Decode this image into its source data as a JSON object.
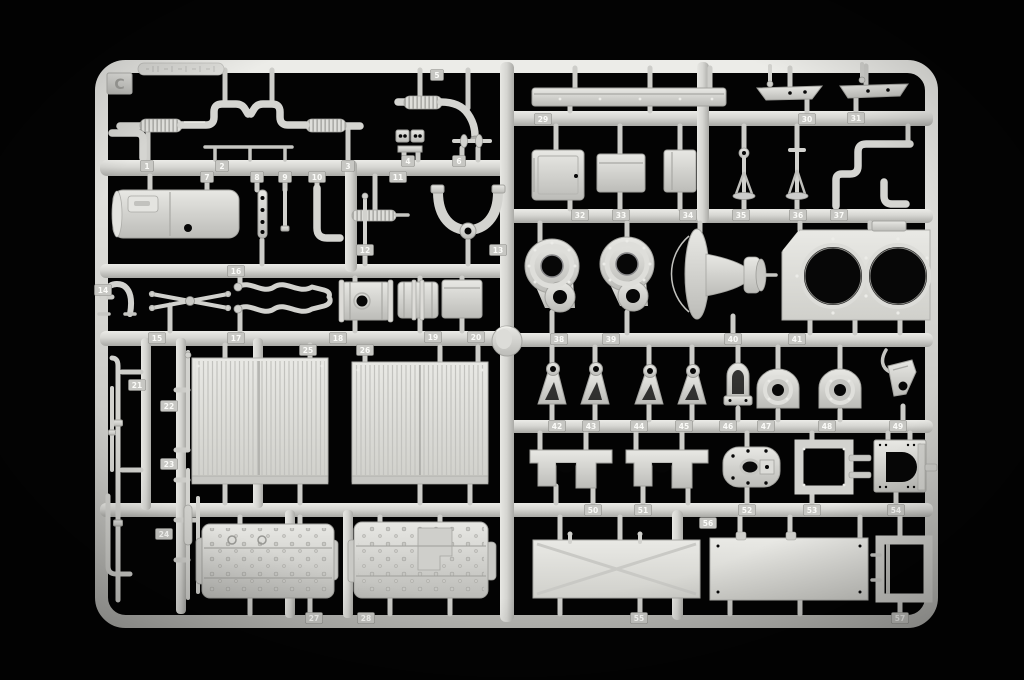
{
  "scene": {
    "background_color": "#030303",
    "plastic_color": "#d6d6d2",
    "tag_color": "#c7c7c3"
  },
  "sprue": {
    "letter": "C",
    "tags": [
      {
        "n": "1",
        "x": 147,
        "y": 166
      },
      {
        "n": "2",
        "x": 222,
        "y": 166
      },
      {
        "n": "3",
        "x": 348,
        "y": 166
      },
      {
        "n": "4",
        "x": 408,
        "y": 161
      },
      {
        "n": "5",
        "x": 437,
        "y": 75
      },
      {
        "n": "6",
        "x": 459,
        "y": 161
      },
      {
        "n": "7",
        "x": 207,
        "y": 177
      },
      {
        "n": "8",
        "x": 257,
        "y": 177
      },
      {
        "n": "9",
        "x": 285,
        "y": 177
      },
      {
        "n": "10",
        "x": 317,
        "y": 177
      },
      {
        "n": "11",
        "x": 398,
        "y": 177
      },
      {
        "n": "12",
        "x": 365,
        "y": 250
      },
      {
        "n": "13",
        "x": 498,
        "y": 250
      },
      {
        "n": "14",
        "x": 103,
        "y": 290
      },
      {
        "n": "15",
        "x": 157,
        "y": 338
      },
      {
        "n": "16",
        "x": 236,
        "y": 271
      },
      {
        "n": "17",
        "x": 236,
        "y": 338
      },
      {
        "n": "18",
        "x": 338,
        "y": 338
      },
      {
        "n": "19",
        "x": 433,
        "y": 337
      },
      {
        "n": "20",
        "x": 476,
        "y": 337
      },
      {
        "n": "21",
        "x": 137,
        "y": 385
      },
      {
        "n": "22",
        "x": 169,
        "y": 406
      },
      {
        "n": "23",
        "x": 169,
        "y": 464
      },
      {
        "n": "24",
        "x": 164,
        "y": 534
      },
      {
        "n": "25",
        "x": 308,
        "y": 350
      },
      {
        "n": "26",
        "x": 365,
        "y": 350
      },
      {
        "n": "27",
        "x": 314,
        "y": 618
      },
      {
        "n": "28",
        "x": 366,
        "y": 618
      },
      {
        "n": "29",
        "x": 543,
        "y": 119
      },
      {
        "n": "30",
        "x": 807,
        "y": 119
      },
      {
        "n": "31",
        "x": 856,
        "y": 118
      },
      {
        "n": "32",
        "x": 580,
        "y": 215
      },
      {
        "n": "33",
        "x": 621,
        "y": 215
      },
      {
        "n": "34",
        "x": 688,
        "y": 215
      },
      {
        "n": "35",
        "x": 741,
        "y": 215
      },
      {
        "n": "36",
        "x": 798,
        "y": 215
      },
      {
        "n": "37",
        "x": 839,
        "y": 215
      },
      {
        "n": "38",
        "x": 559,
        "y": 339
      },
      {
        "n": "39",
        "x": 611,
        "y": 339
      },
      {
        "n": "40",
        "x": 733,
        "y": 339
      },
      {
        "n": "41",
        "x": 797,
        "y": 339
      },
      {
        "n": "42",
        "x": 557,
        "y": 426
      },
      {
        "n": "43",
        "x": 591,
        "y": 426
      },
      {
        "n": "44",
        "x": 639,
        "y": 426
      },
      {
        "n": "45",
        "x": 684,
        "y": 426
      },
      {
        "n": "46",
        "x": 728,
        "y": 426
      },
      {
        "n": "47",
        "x": 766,
        "y": 426
      },
      {
        "n": "48",
        "x": 827,
        "y": 426
      },
      {
        "n": "49",
        "x": 898,
        "y": 426
      },
      {
        "n": "50",
        "x": 593,
        "y": 510
      },
      {
        "n": "51",
        "x": 643,
        "y": 510
      },
      {
        "n": "52",
        "x": 747,
        "y": 510
      },
      {
        "n": "53",
        "x": 812,
        "y": 510
      },
      {
        "n": "54",
        "x": 896,
        "y": 510
      },
      {
        "n": "55",
        "x": 639,
        "y": 618
      },
      {
        "n": "56",
        "x": 708,
        "y": 523
      },
      {
        "n": "57",
        "x": 900,
        "y": 618
      }
    ]
  }
}
